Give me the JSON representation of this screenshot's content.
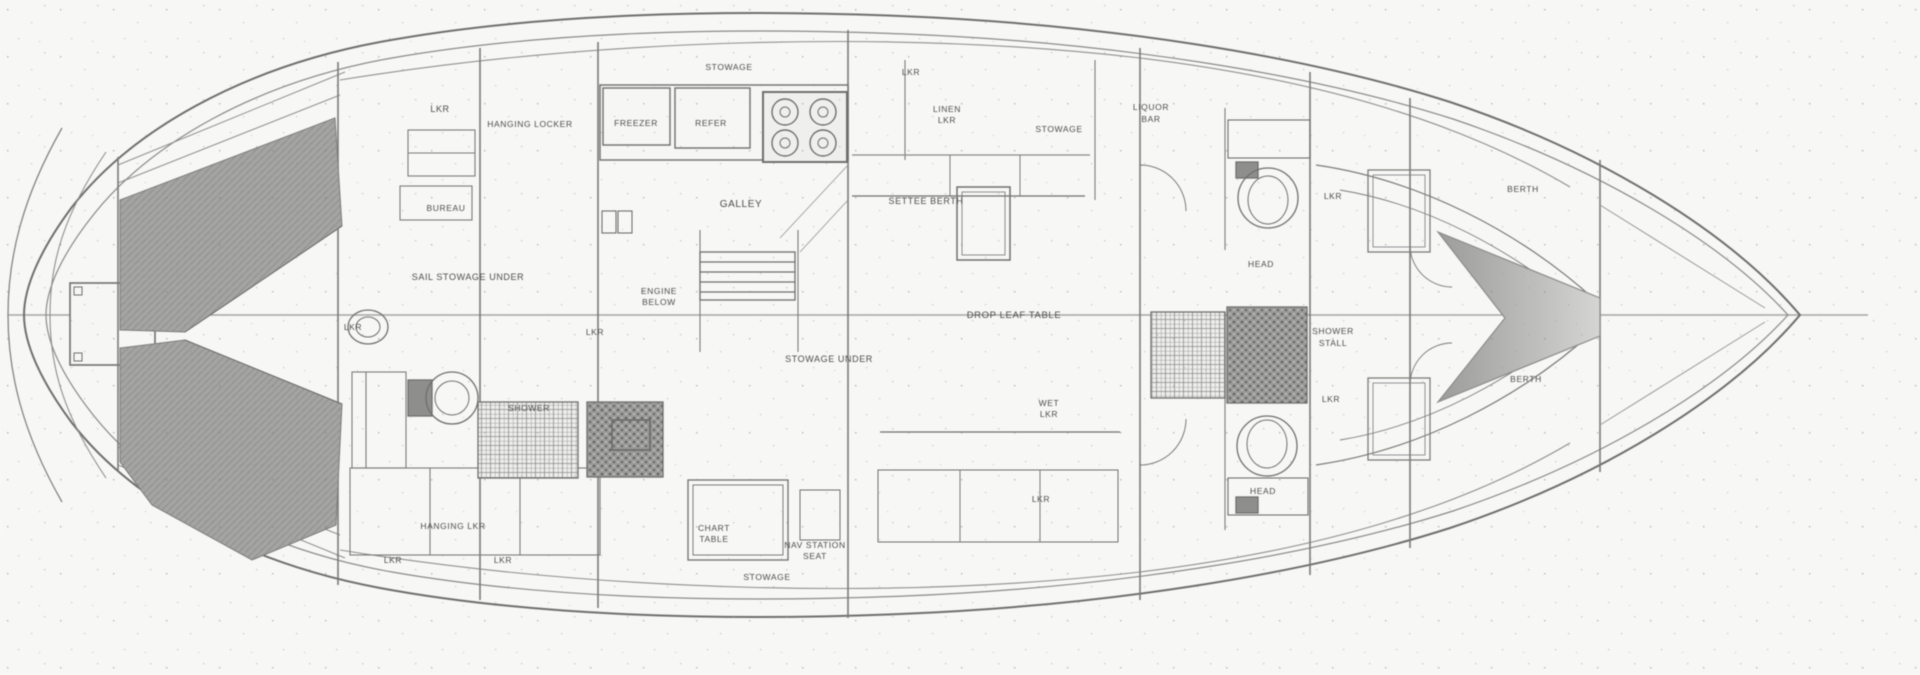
{
  "diagram": {
    "type": "boat-floor-plan",
    "description": "Hand-drawn sailboat interior arrangement plan, bow to the right, stern to the left",
    "colors": {
      "background": "#fcfcfb",
      "line": "#6e6e6c",
      "light_line": "#9a9a98",
      "berth_shade": "#a3a3a1",
      "dark_block": "#8f8f8d",
      "label": "#4a4a48"
    }
  },
  "labels": [
    {
      "text": "LKR",
      "x": 440,
      "y": 112,
      "size": 9
    },
    {
      "text": "HANGING LOCKER",
      "x": 530,
      "y": 127,
      "size": 8.5
    },
    {
      "text": "FREEZER",
      "x": 636,
      "y": 126,
      "size": 8.5
    },
    {
      "text": "REFER",
      "x": 711,
      "y": 126,
      "size": 8.5
    },
    {
      "text": "STOWAGE",
      "x": 729,
      "y": 70,
      "size": 8.5
    },
    {
      "text": "GALLEY",
      "x": 741,
      "y": 207,
      "size": 10,
      "spacing": 2
    },
    {
      "text": "BUREAU",
      "x": 446,
      "y": 211,
      "size": 8.5
    },
    {
      "text": "SAIL STOWAGE UNDER",
      "x": 468,
      "y": 280,
      "size": 9,
      "spacing": 1.5
    },
    {
      "text": "LKR",
      "x": 353,
      "y": 330,
      "size": 8.5
    },
    {
      "text": "ENGINE",
      "x": 659,
      "y": 294,
      "size": 8.5
    },
    {
      "text": "BELOW",
      "x": 659,
      "y": 305,
      "size": 8.5
    },
    {
      "text": "LKR",
      "x": 595,
      "y": 335,
      "size": 8.5
    },
    {
      "text": "SHOWER",
      "x": 529,
      "y": 411,
      "size": 8.5
    },
    {
      "text": "HANGING LKR",
      "x": 453,
      "y": 529,
      "size": 8.5
    },
    {
      "text": "LKR",
      "x": 393,
      "y": 563,
      "size": 8.5
    },
    {
      "text": "LKR",
      "x": 503,
      "y": 563,
      "size": 8.5
    },
    {
      "text": "CHART",
      "x": 714,
      "y": 531,
      "size": 8.5
    },
    {
      "text": "TABLE",
      "x": 714,
      "y": 542,
      "size": 8.5
    },
    {
      "text": "NAV STATION",
      "x": 815,
      "y": 548,
      "size": 8.5
    },
    {
      "text": "SEAT",
      "x": 815,
      "y": 559,
      "size": 8.5
    },
    {
      "text": "STOWAGE",
      "x": 767,
      "y": 580,
      "size": 8.5
    },
    {
      "text": "LKR",
      "x": 911,
      "y": 75,
      "size": 8.5
    },
    {
      "text": "LINEN",
      "x": 947,
      "y": 112,
      "size": 8.5
    },
    {
      "text": "LKR",
      "x": 947,
      "y": 123,
      "size": 8.5
    },
    {
      "text": "STOWAGE",
      "x": 1059,
      "y": 132,
      "size": 8.5
    },
    {
      "text": "SETTEE BERTH",
      "x": 926,
      "y": 204,
      "size": 9
    },
    {
      "text": "DROP LEAF TABLE",
      "x": 1014,
      "y": 318,
      "size": 9.5,
      "spacing": 2
    },
    {
      "text": "STOWAGE UNDER",
      "x": 829,
      "y": 362,
      "size": 9
    },
    {
      "text": "WET",
      "x": 1049,
      "y": 406,
      "size": 8.5
    },
    {
      "text": "LKR",
      "x": 1049,
      "y": 417,
      "size": 8.5
    },
    {
      "text": "LKR",
      "x": 1041,
      "y": 502,
      "size": 8.5
    },
    {
      "text": "LIQUOR",
      "x": 1151,
      "y": 110,
      "size": 8.5
    },
    {
      "text": "BAR",
      "x": 1151,
      "y": 122,
      "size": 8.5
    },
    {
      "text": "LKR",
      "x": 1333,
      "y": 199,
      "size": 8.5
    },
    {
      "text": "HEAD",
      "x": 1261,
      "y": 267,
      "size": 8.5
    },
    {
      "text": "SHOWER",
      "x": 1333,
      "y": 334,
      "size": 8.5
    },
    {
      "text": "STALL",
      "x": 1333,
      "y": 346,
      "size": 8.5
    },
    {
      "text": "LKR",
      "x": 1331,
      "y": 402,
      "size": 8.5
    },
    {
      "text": "HEAD",
      "x": 1263,
      "y": 494,
      "size": 8.5
    },
    {
      "text": "BERTH",
      "x": 1523,
      "y": 192,
      "size": 8.5
    },
    {
      "text": "BERTH",
      "x": 1526,
      "y": 382,
      "size": 8.5
    }
  ]
}
